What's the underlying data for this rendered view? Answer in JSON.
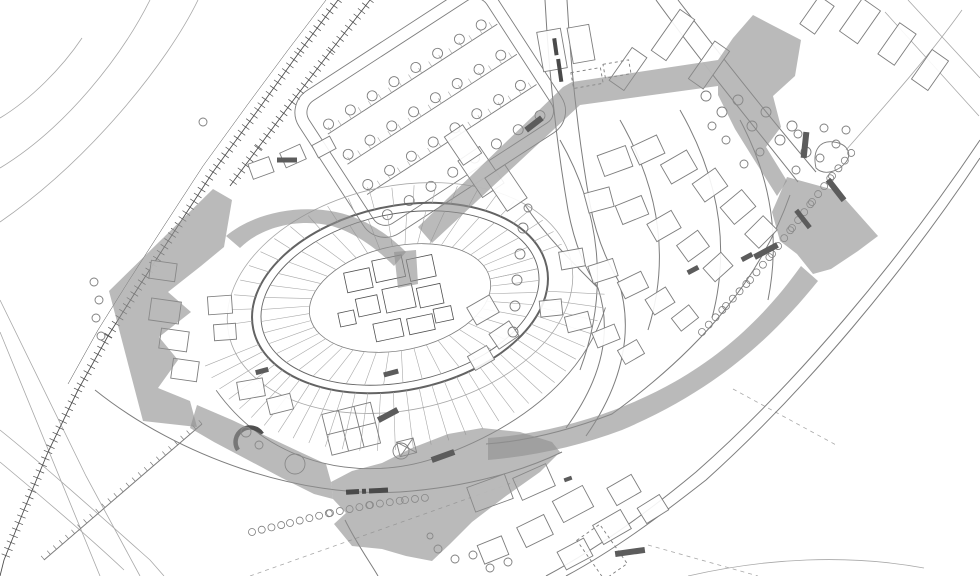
{
  "colors": {
    "background": "#ffffff",
    "linework": "#7d7d7d",
    "linework_light": "#a8a8a8",
    "linework_dark": "#4f4f4f",
    "wall": "#636363",
    "pedestrian_fill": "#8f8f8f",
    "marker_fill": "#5c5c5c",
    "building_fill": "#ffffff",
    "label_ink": "#4a4a4a"
  },
  "features": [
    {
      "id": "railway",
      "name": "railway-tracks-with-tie-hatching"
    },
    {
      "id": "parking-lot",
      "name": "tree-lined-parking-area"
    },
    {
      "id": "old-town-oval",
      "name": "oval-walled-old-town-with-radial-plots"
    },
    {
      "id": "pedestrian-network",
      "name": "grey-pedestrian-route-and-squares"
    },
    {
      "id": "west-wedge-square",
      "name": "wedge-shaped-square-west"
    },
    {
      "id": "northeast-square",
      "name": "grey-square-north-east"
    },
    {
      "id": "east-square",
      "name": "grey-square-east"
    },
    {
      "id": "south-square",
      "name": "grey-square-south"
    },
    {
      "id": "southeast-promenade",
      "name": "curved-grey-promenade"
    },
    {
      "id": "ring-road",
      "name": "curved-ring-road-south-east"
    },
    {
      "id": "trees",
      "name": "street-tree-circles"
    },
    {
      "id": "surface-markers",
      "name": "dark-paving-markers"
    },
    {
      "id": "street-label",
      "name": "tiny-street-name-text-illegible"
    },
    {
      "id": "square-label",
      "name": "tiny-square-name-text-illegible"
    }
  ]
}
